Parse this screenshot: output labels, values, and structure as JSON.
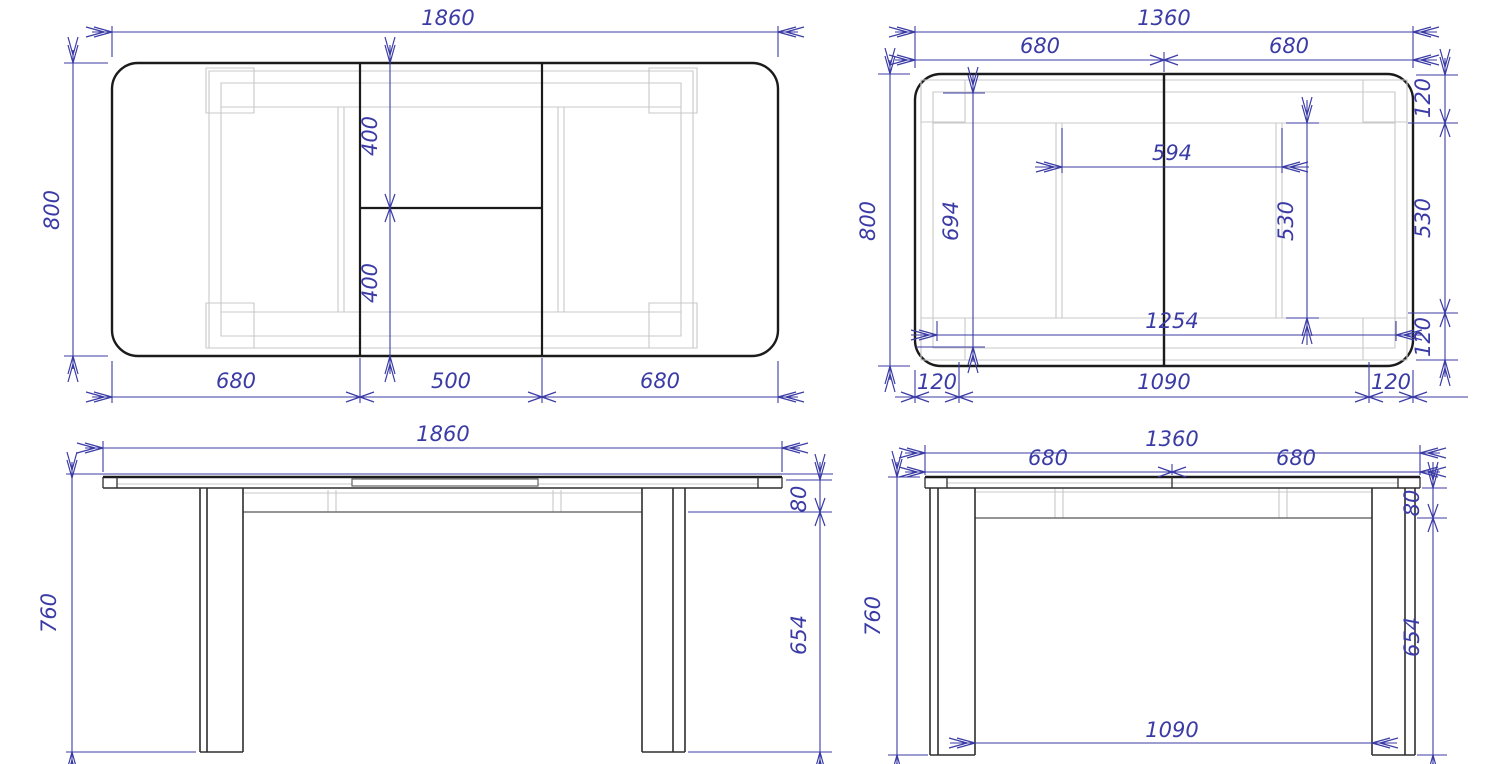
{
  "drawing": {
    "palette": {
      "dimension_blue": "#3b3ba6",
      "outline_black": "#1b1b1b",
      "construction_gray": "#c8c8c8"
    },
    "views": {
      "top_extended": {
        "dims": {
          "total_width": "1860",
          "depth": "800",
          "insert_top": "400",
          "insert_bottom": "400",
          "left_section": "680",
          "insert_width": "500",
          "right_section": "680"
        }
      },
      "top_closed": {
        "dims": {
          "total_width": "1360",
          "left_half": "680",
          "right_half": "680",
          "depth": "800",
          "frame_inner_depth": "694",
          "runner_gap": "594",
          "edge_top": "120",
          "side_panel": "530",
          "edge_bottom": "120",
          "frame_length": "1254",
          "runner_length": "530",
          "leg_inset_left": "120",
          "legs_span": "1090",
          "leg_inset_right": "120"
        }
      },
      "front_extended": {
        "dims": {
          "total_width": "1860",
          "height": "760",
          "apron_height": "80",
          "leg_height": "654"
        }
      },
      "front_closed": {
        "dims": {
          "total_width": "1360",
          "left_half": "680",
          "right_half": "680",
          "height": "760",
          "apron_height": "80",
          "leg_height": "654",
          "legs_span": "1090"
        }
      }
    }
  }
}
